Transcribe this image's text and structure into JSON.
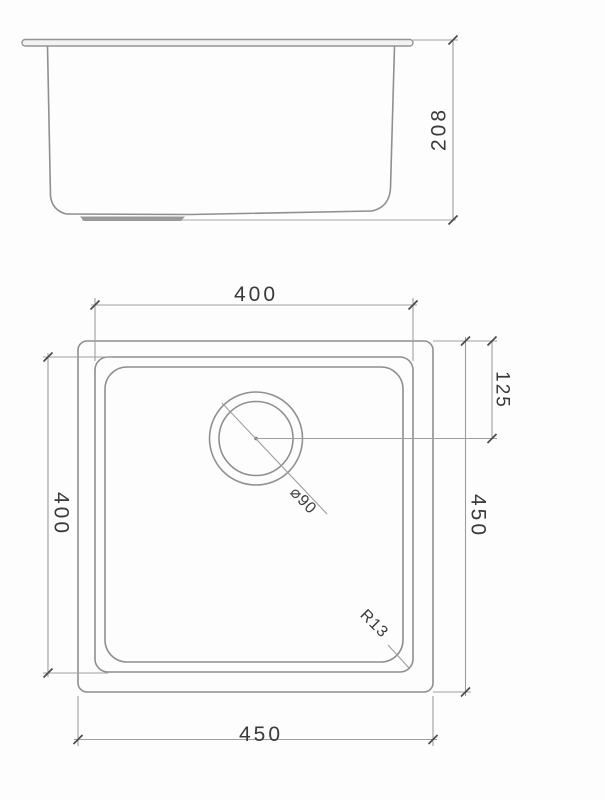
{
  "drawing": {
    "type": "technical-dimension-drawing",
    "subject": "undermount square sink, side elevation and plan view",
    "colors": {
      "background": "#fdfdfd",
      "geometry_line": "#8f8f8f",
      "dimension_line": "#9e9e9e",
      "text": "#3a3a3a",
      "drain_pad_fill": "#9a9a9a"
    },
    "side_view": {
      "height_label": "208"
    },
    "plan_view": {
      "top_width_label": "400",
      "left_height_label": "400",
      "bottom_width_label": "450",
      "right_height_label": "450",
      "drain_offset_label": "125",
      "drain_diameter_label": "⌀90",
      "corner_radius_label": "R13"
    }
  }
}
